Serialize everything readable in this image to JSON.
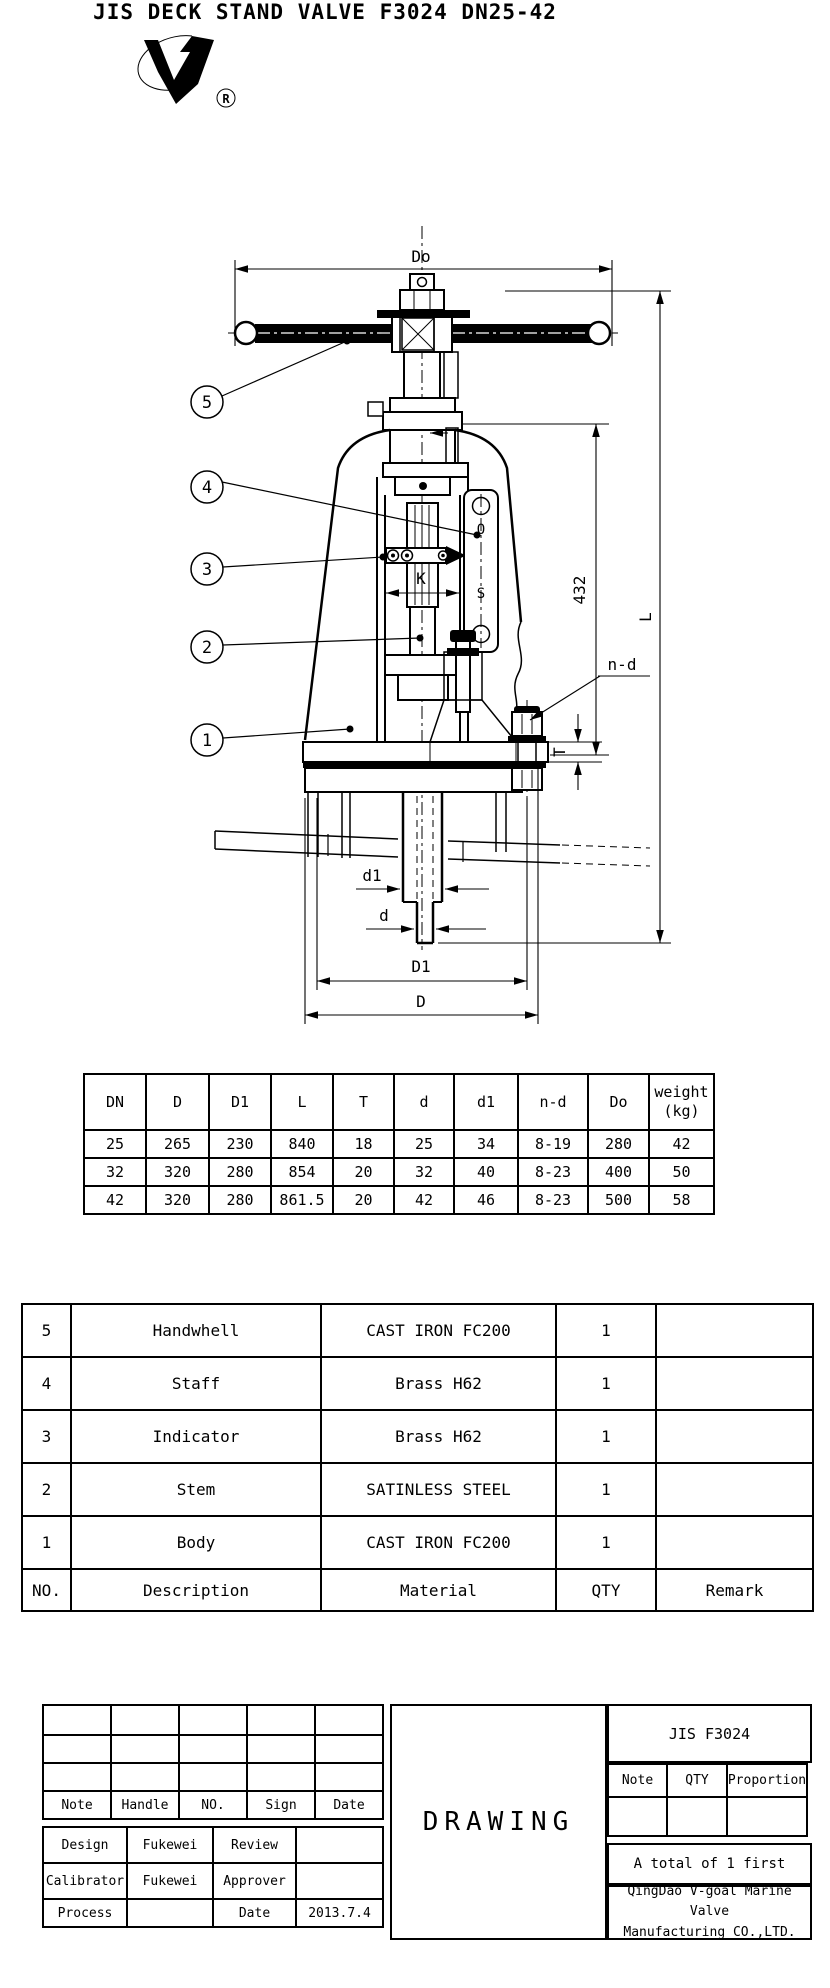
{
  "page": {
    "title": "JIS DECK STAND VALVE F3024 DN25-42"
  },
  "logo": {
    "name": "v-goal-brand-logo",
    "registered_mark": "R"
  },
  "drawing": {
    "callouts": [
      "1",
      "2",
      "3",
      "4",
      "5"
    ],
    "labels": {
      "do": "Do",
      "l": "L",
      "h432": "432",
      "nd": "n-d",
      "t": "T",
      "k": "K",
      "d1_small": "d1",
      "d_small": "d",
      "d1_big": "D1",
      "d_big": "D",
      "indicator_open": "O",
      "indicator_shut": "S"
    }
  },
  "dimension_table": {
    "headers": [
      "DN",
      "D",
      "D1",
      "L",
      "T",
      "d",
      "d1",
      "n-d",
      "Do",
      "weight\n(kg)"
    ],
    "rows": [
      [
        "25",
        "265",
        "230",
        "840",
        "18",
        "25",
        "34",
        "8-19",
        "280",
        "42"
      ],
      [
        "32",
        "320",
        "280",
        "854",
        "20",
        "32",
        "40",
        "8-23",
        "400",
        "50"
      ],
      [
        "42",
        "320",
        "280",
        "861.5",
        "20",
        "42",
        "46",
        "8-23",
        "500",
        "58"
      ]
    ]
  },
  "parts_list": {
    "rows": [
      [
        "5",
        "Handwhell",
        "CAST IRON FC200",
        "1",
        ""
      ],
      [
        "4",
        "Staff",
        "Brass H62",
        "1",
        ""
      ],
      [
        "3",
        "Indicator",
        "Brass H62",
        "1",
        ""
      ],
      [
        "2",
        "Stem",
        "SATINLESS STEEL",
        "1",
        ""
      ],
      [
        "1",
        "Body",
        "CAST IRON FC200",
        "1",
        ""
      ]
    ],
    "footer": [
      "NO.",
      "Description",
      "Material",
      "QTY",
      "Remark"
    ]
  },
  "title_block": {
    "approval_headers": [
      "Note",
      "Handle",
      "NO.",
      "Sign",
      "Date"
    ],
    "rows": [
      {
        "label": "Design",
        "name": "Fukewei",
        "label2": "Review",
        "value": ""
      },
      {
        "label": "Calibrator",
        "name": "Fukewei",
        "label2": "Approver",
        "value": ""
      },
      {
        "label": "Process",
        "name": "",
        "label2": "Date",
        "value": "2013.7.4"
      }
    ],
    "drawing_label": "DRAWING",
    "doc_code": "JIS F3024",
    "spec_headers": [
      "Note",
      "QTY",
      "Proportion"
    ],
    "total_note": "A total of 1 first",
    "company": "QingDao V-goal Marine Valve\nManufacturing CO.,LTD."
  }
}
